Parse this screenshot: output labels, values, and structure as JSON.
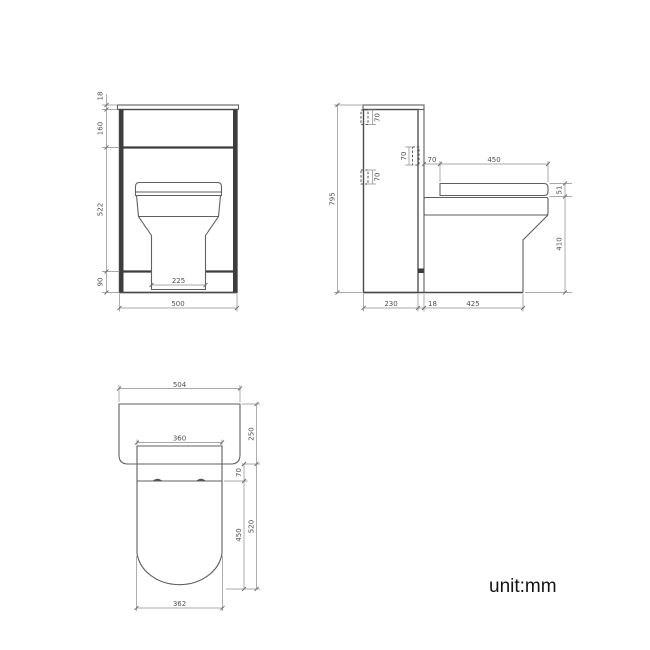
{
  "note": {
    "unit": "unit:mm"
  },
  "colors": {
    "background": "#ffffff",
    "object_line": "#4a4a4a",
    "object_line_dark": "#3d3d3d",
    "dimension_line": "#8c8c8c",
    "dimension_text": "#4f4f4f",
    "note_text": "#141414"
  },
  "views": {
    "front": {
      "dims": {
        "countertop_thickness": "18",
        "upper_panel_height": "160",
        "body_height": "522",
        "plinth_height": "90",
        "overall_width": "500",
        "pedestal_width": "225"
      }
    },
    "side": {
      "dims": {
        "overall_height": "795",
        "top_bracket_height": "70",
        "mid_bracket_height": "70",
        "panel_bracket_height": "70",
        "seat_setback": "70",
        "seat_depth": "450",
        "seat_thickness": "51",
        "pan_height": "410",
        "cabinet_depth": "230",
        "panel_thickness": "18",
        "pan_projection": "425"
      }
    },
    "plan": {
      "dims": {
        "counter_width": "504",
        "counter_depth": "250",
        "seat_width": "360",
        "hinge_offset": "70",
        "seat_length": "450",
        "total_projection": "520",
        "pan_width": "362"
      }
    }
  }
}
